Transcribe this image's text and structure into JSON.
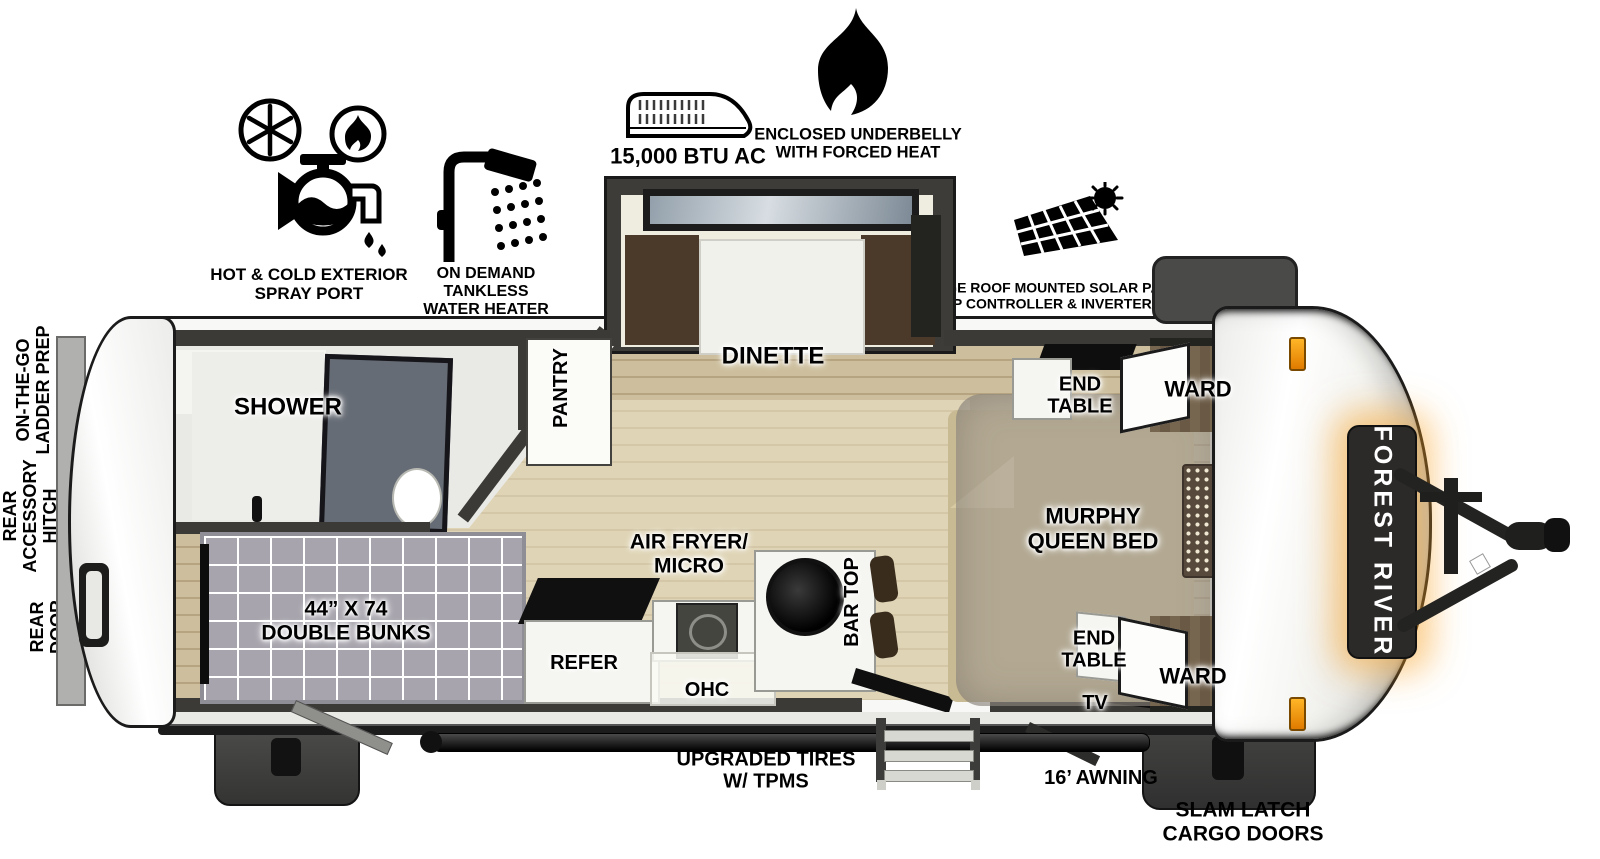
{
  "brand": "FOREST RIVER",
  "feature_callouts": {
    "spray_port": {
      "icon": "faucet-hot-cold-icon",
      "lines": [
        "HOT & COLD EXTERIOR",
        "SPRAY PORT"
      ]
    },
    "water_heater": {
      "icon": "shower-head-icon",
      "lines": [
        "ON DEMAND",
        "TANKLESS",
        "WATER HEATER"
      ]
    },
    "ac": {
      "icon": "rooftop-ac-icon",
      "label": "15,000 BTU AC"
    },
    "underbelly": {
      "icon": "flame-icon",
      "lines": [
        "ENCLOSED UNDERBELLY",
        "WITH FORCED HEAT"
      ]
    },
    "solar": {
      "icon": "solar-panel-icon",
      "lines": [
        "LARGE ROOF MOUNTED SOLAR PANEL",
        "30 AMP CONTROLLER & INVERTER PREP"
      ]
    }
  },
  "rear_callouts": {
    "ladder_prep": {
      "lines": [
        "ON-THE-GO",
        "LADDER PREP"
      ]
    },
    "accessory_hitch": {
      "lines": [
        "REAR",
        "ACCESSORY",
        "HITCH"
      ]
    },
    "rear_door": {
      "lines": [
        "REAR",
        "DOOR"
      ]
    }
  },
  "rooms": {
    "shower": "SHOWER",
    "pantry": "PANTRY",
    "dinette": "DINETTE",
    "bunks": {
      "lines": [
        "44” X 74",
        "DOUBLE BUNKS"
      ]
    },
    "refer": "REFER",
    "air_fryer": {
      "lines": [
        "AIR FRYER/",
        "MICRO"
      ]
    },
    "ohc": "OHC",
    "bar_top": "BAR TOP",
    "tv": "TV",
    "murphy_bed": {
      "lines": [
        "MURPHY",
        "QUEEN BED"
      ]
    },
    "end_table_top": {
      "lines": [
        "END",
        "TABLE"
      ]
    },
    "ward_top": "WARD",
    "end_table_bottom": {
      "lines": [
        "END",
        "TABLE"
      ]
    },
    "ward_bottom": "WARD"
  },
  "bottom_callouts": {
    "tires": {
      "lines": [
        "UPGRADED TIRES",
        "W/ TPMS"
      ]
    },
    "awning": "16’ AWNING",
    "cargo": {
      "lines": [
        "SLAM LATCH",
        "CARGO DOORS"
      ]
    }
  },
  "colors": {
    "wall": "#3b3a36",
    "floor_tan": "#c9bb93",
    "accent_orange": "#f5a21c",
    "mattress_gray": "#a7a4ad",
    "bench_brown": "#4b3929"
  }
}
